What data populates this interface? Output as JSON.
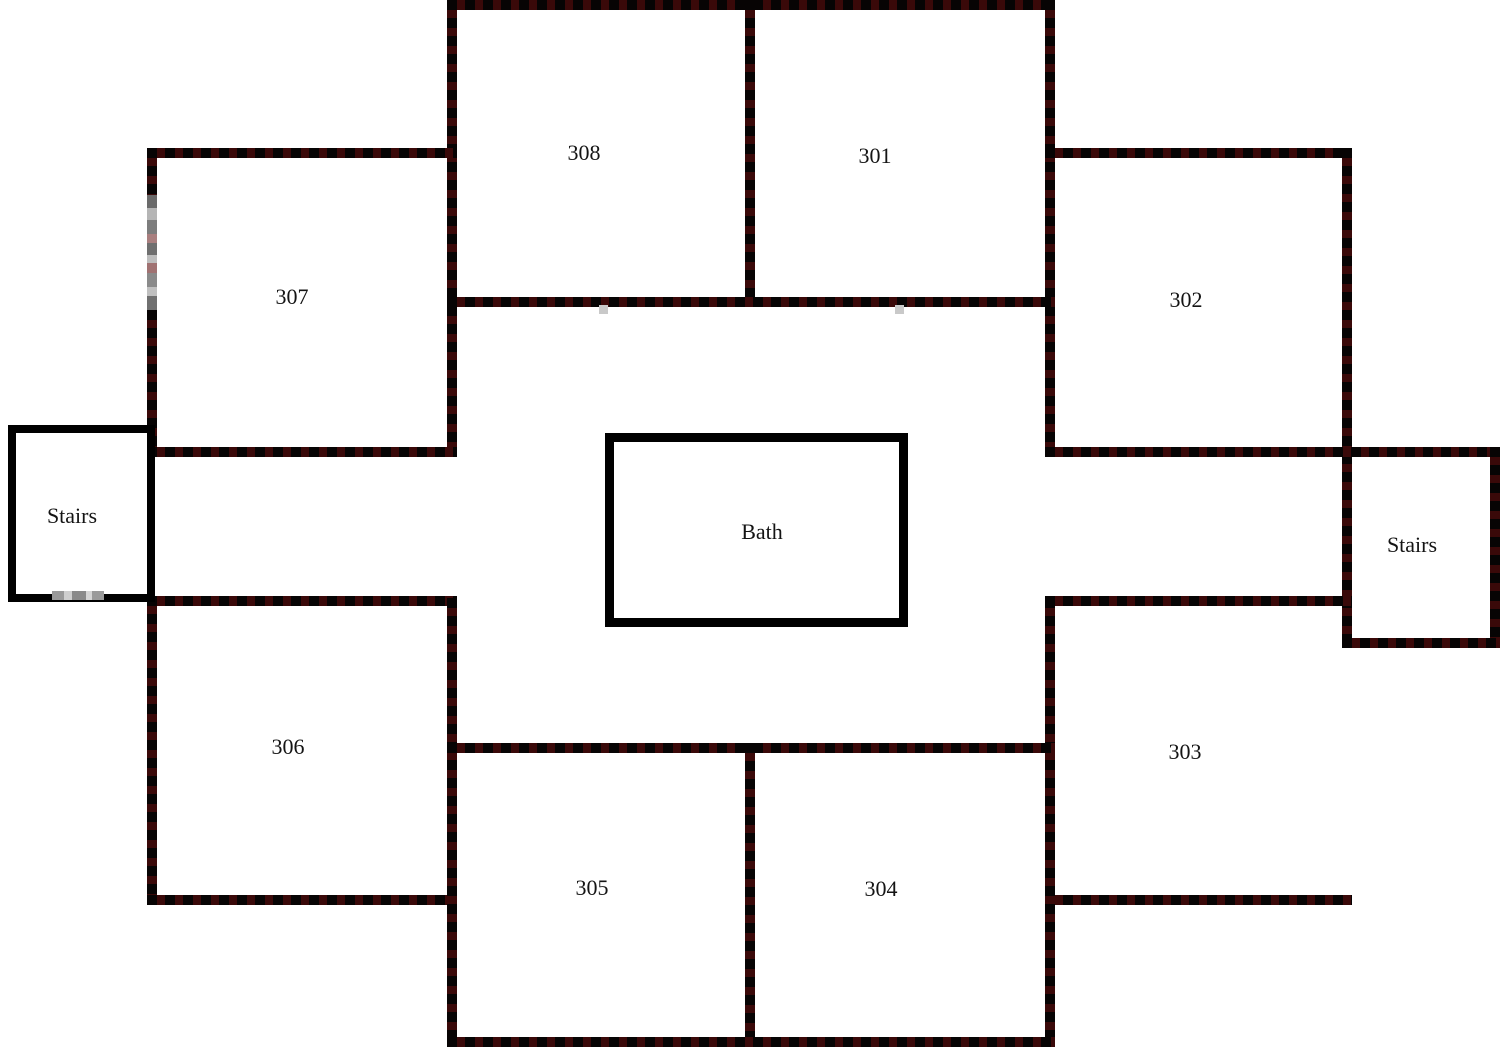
{
  "diagram": {
    "type": "floor-plan",
    "floor_rooms": [
      "301",
      "302",
      "303",
      "304",
      "305",
      "306",
      "307",
      "308"
    ],
    "common_areas": [
      "Bath",
      "Stairs",
      "Stairs"
    ]
  },
  "labels": {
    "room308": "308",
    "room301": "301",
    "room307": "307",
    "room302": "302",
    "room306": "306",
    "room303": "303",
    "room305": "305",
    "room304": "304",
    "bath": "Bath",
    "stairsLeft": "Stairs",
    "stairsRight": "Stairs"
  },
  "colors": {
    "background": "#ffffff",
    "wall_dash_black": "#070404",
    "wall_dash_maroon": "#3a0909",
    "wall_solid": "#000000",
    "label_text": "#141414"
  }
}
